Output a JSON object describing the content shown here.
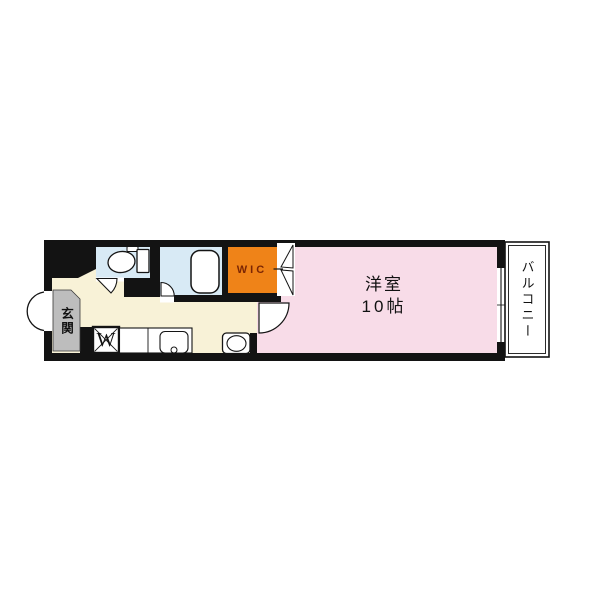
{
  "floorplan": {
    "kind": "apartment-floor-plan",
    "labels": {
      "western_room_line1": "洋室",
      "western_room_line2": "10帖",
      "wic": "WIC",
      "balcony": "バルコニー",
      "entrance": "玄関",
      "washer": "W"
    },
    "colors": {
      "wall": "#131313",
      "hallway_cream": "#F8F2D7",
      "wet_area_blue": "#D8EAF5",
      "room_pink": "#F8DCE8",
      "wic_orange": "#EF8318",
      "wic_text": "#7B2604",
      "entrance_gray": "#BDBDBD",
      "fixture_white": "#FFFFFF"
    }
  }
}
